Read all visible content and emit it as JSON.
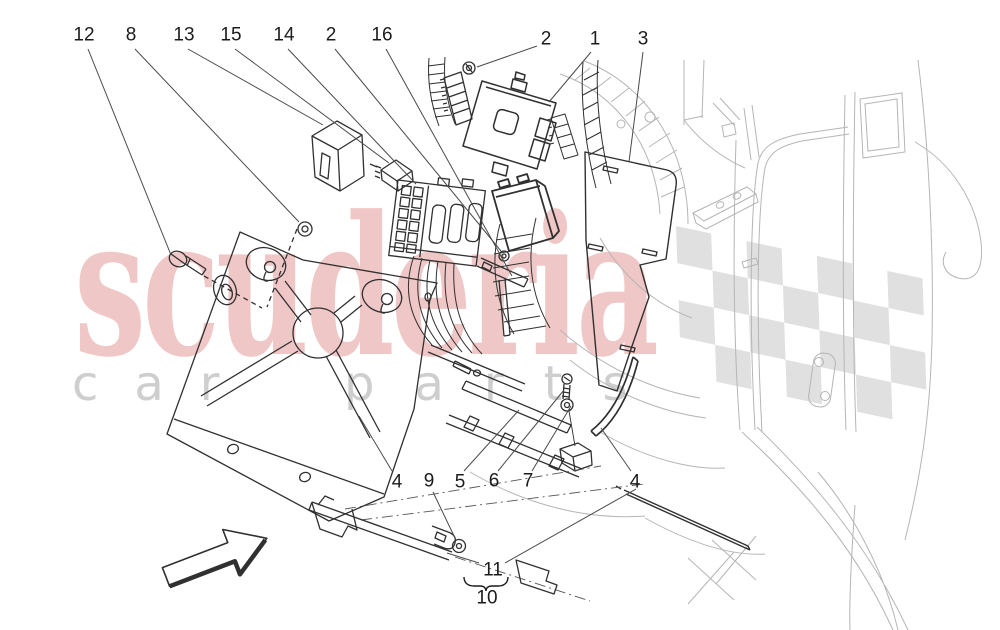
{
  "watermark": {
    "brand": "scuderia",
    "tagline_left": "car",
    "tagline_right": "parts",
    "brand_color": "#d04848",
    "tagline_color": "#c9c9c9",
    "checker_color": "#d9d9d9"
  },
  "callouts": [
    {
      "label": "12",
      "x": 84,
      "y": 35,
      "leader": [
        88,
        49,
        171,
        255
      ]
    },
    {
      "label": "8",
      "x": 131,
      "y": 35,
      "leader": [
        135,
        49,
        299,
        222
      ]
    },
    {
      "label": "13",
      "x": 184,
      "y": 35,
      "leader": [
        188,
        49,
        323,
        125
      ]
    },
    {
      "label": "15",
      "x": 231,
      "y": 35,
      "leader": [
        235,
        49,
        389,
        163
      ]
    },
    {
      "label": "14",
      "x": 284,
      "y": 35,
      "leader": [
        288,
        49,
        416,
        184
      ]
    },
    {
      "label": "2",
      "x": 331,
      "y": 35,
      "leader": [
        335,
        49,
        501,
        251
      ]
    },
    {
      "label": "16",
      "x": 382,
      "y": 35,
      "leader": [
        386,
        49,
        512,
        276
      ]
    },
    {
      "label": "2",
      "x": 546,
      "y": 39,
      "leader": [
        537,
        46,
        477,
        67
      ]
    },
    {
      "label": "1",
      "x": 595,
      "y": 39,
      "leader": [
        591,
        52,
        549,
        102
      ]
    },
    {
      "label": "3",
      "x": 643,
      "y": 39,
      "leader": [
        643,
        52,
        629,
        162
      ]
    },
    {
      "label": "4",
      "x": 397,
      "y": 482,
      "leader": [
        392,
        471,
        359,
        416
      ]
    },
    {
      "label": "9",
      "x": 429,
      "y": 481,
      "leader": [
        433,
        492,
        455,
        538
      ]
    },
    {
      "label": "5",
      "x": 460,
      "y": 482,
      "leader": [
        464,
        471,
        519,
        410
      ]
    },
    {
      "label": "6",
      "x": 494,
      "y": 481,
      "leader": [
        498,
        471,
        564,
        390
      ]
    },
    {
      "label": "7",
      "x": 528,
      "y": 481,
      "leader": [
        532,
        471,
        571,
        406
      ]
    },
    {
      "label": "4",
      "x": 635,
      "y": 482,
      "leader": [
        631,
        471,
        601,
        428
      ]
    },
    {
      "label": "11",
      "x": 493,
      "y": 570,
      "leader": [
        505,
        563,
        636,
        489
      ],
      "leader2": [
        479,
        563,
        447,
        553
      ]
    }
  ],
  "assembly_group": {
    "item_label": "11",
    "group_label": "10"
  }
}
